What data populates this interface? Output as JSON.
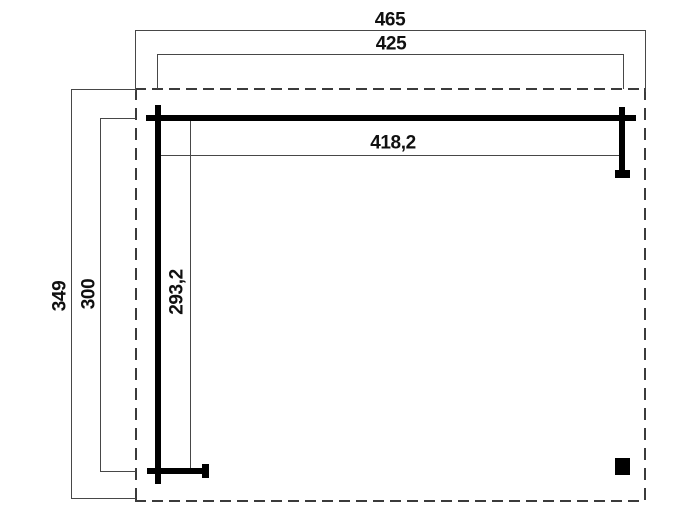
{
  "drawing": {
    "kind": "carport-canopy-dimension-plan",
    "background": "#ffffff",
    "colors": {
      "structure_line": "#000000",
      "dimension_line": "#474747",
      "dashed_outline": "#3b3b3b",
      "label_text": "#101010"
    }
  },
  "labels": {
    "width_outer": "465",
    "width_beam": "425",
    "width_post_span": "418,2",
    "height_outer": "349",
    "height_post": "300",
    "height_post_span": "293,2"
  },
  "dimensions": [
    {
      "value": "465",
      "orientation": "horizontal",
      "measures": "outer dashed roof outline width"
    },
    {
      "value": "425",
      "orientation": "horizontal",
      "measures": "front beam width"
    },
    {
      "value": "418,2",
      "orientation": "horizontal",
      "measures": "span between post centers (width)"
    },
    {
      "value": "349",
      "orientation": "vertical",
      "measures": "outer dashed roof outline depth"
    },
    {
      "value": "300",
      "orientation": "vertical",
      "measures": "side beam depth"
    },
    {
      "value": "293,2",
      "orientation": "vertical",
      "measures": "span between post centers (depth)"
    }
  ]
}
